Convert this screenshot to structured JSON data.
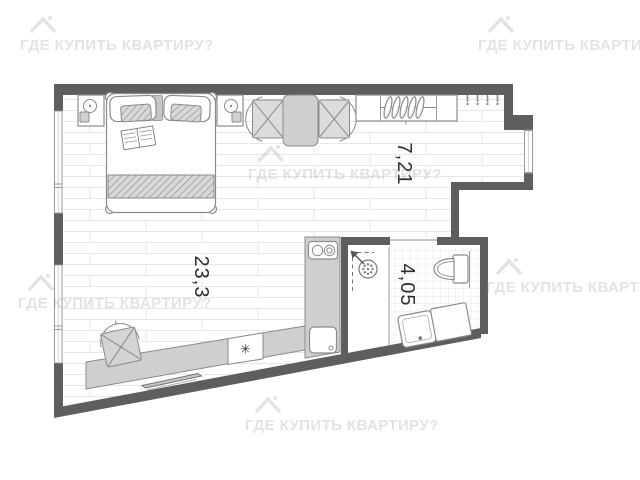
{
  "watermark": {
    "brand_text": "ГДЕ КУПИТЬ КВАРТИРУ?"
  },
  "floor_plan": {
    "room_labels": [
      {
        "id": "hall-zone",
        "area_m2": "7,21"
      },
      {
        "id": "main-room",
        "area_m2": "23,3"
      },
      {
        "id": "bathroom",
        "area_m2": "4,05"
      }
    ],
    "fridge_symbol": "✳",
    "icons": {
      "house_logo": "house-roof-with-chimney",
      "shower_drain": "round-drain-with-dots",
      "fridge": "snowflake",
      "lamps": "bedside-lamp"
    },
    "colors": {
      "wall": "#5e5e5e",
      "furniture_fill": "#cfcfcf",
      "furniture_stroke": "#8b8b8b",
      "floor_line": "#e7e7e7",
      "tile_line": "#dedede",
      "label": "#2e2e2e",
      "watermark": "rgba(145,145,145,0.25)"
    }
  }
}
